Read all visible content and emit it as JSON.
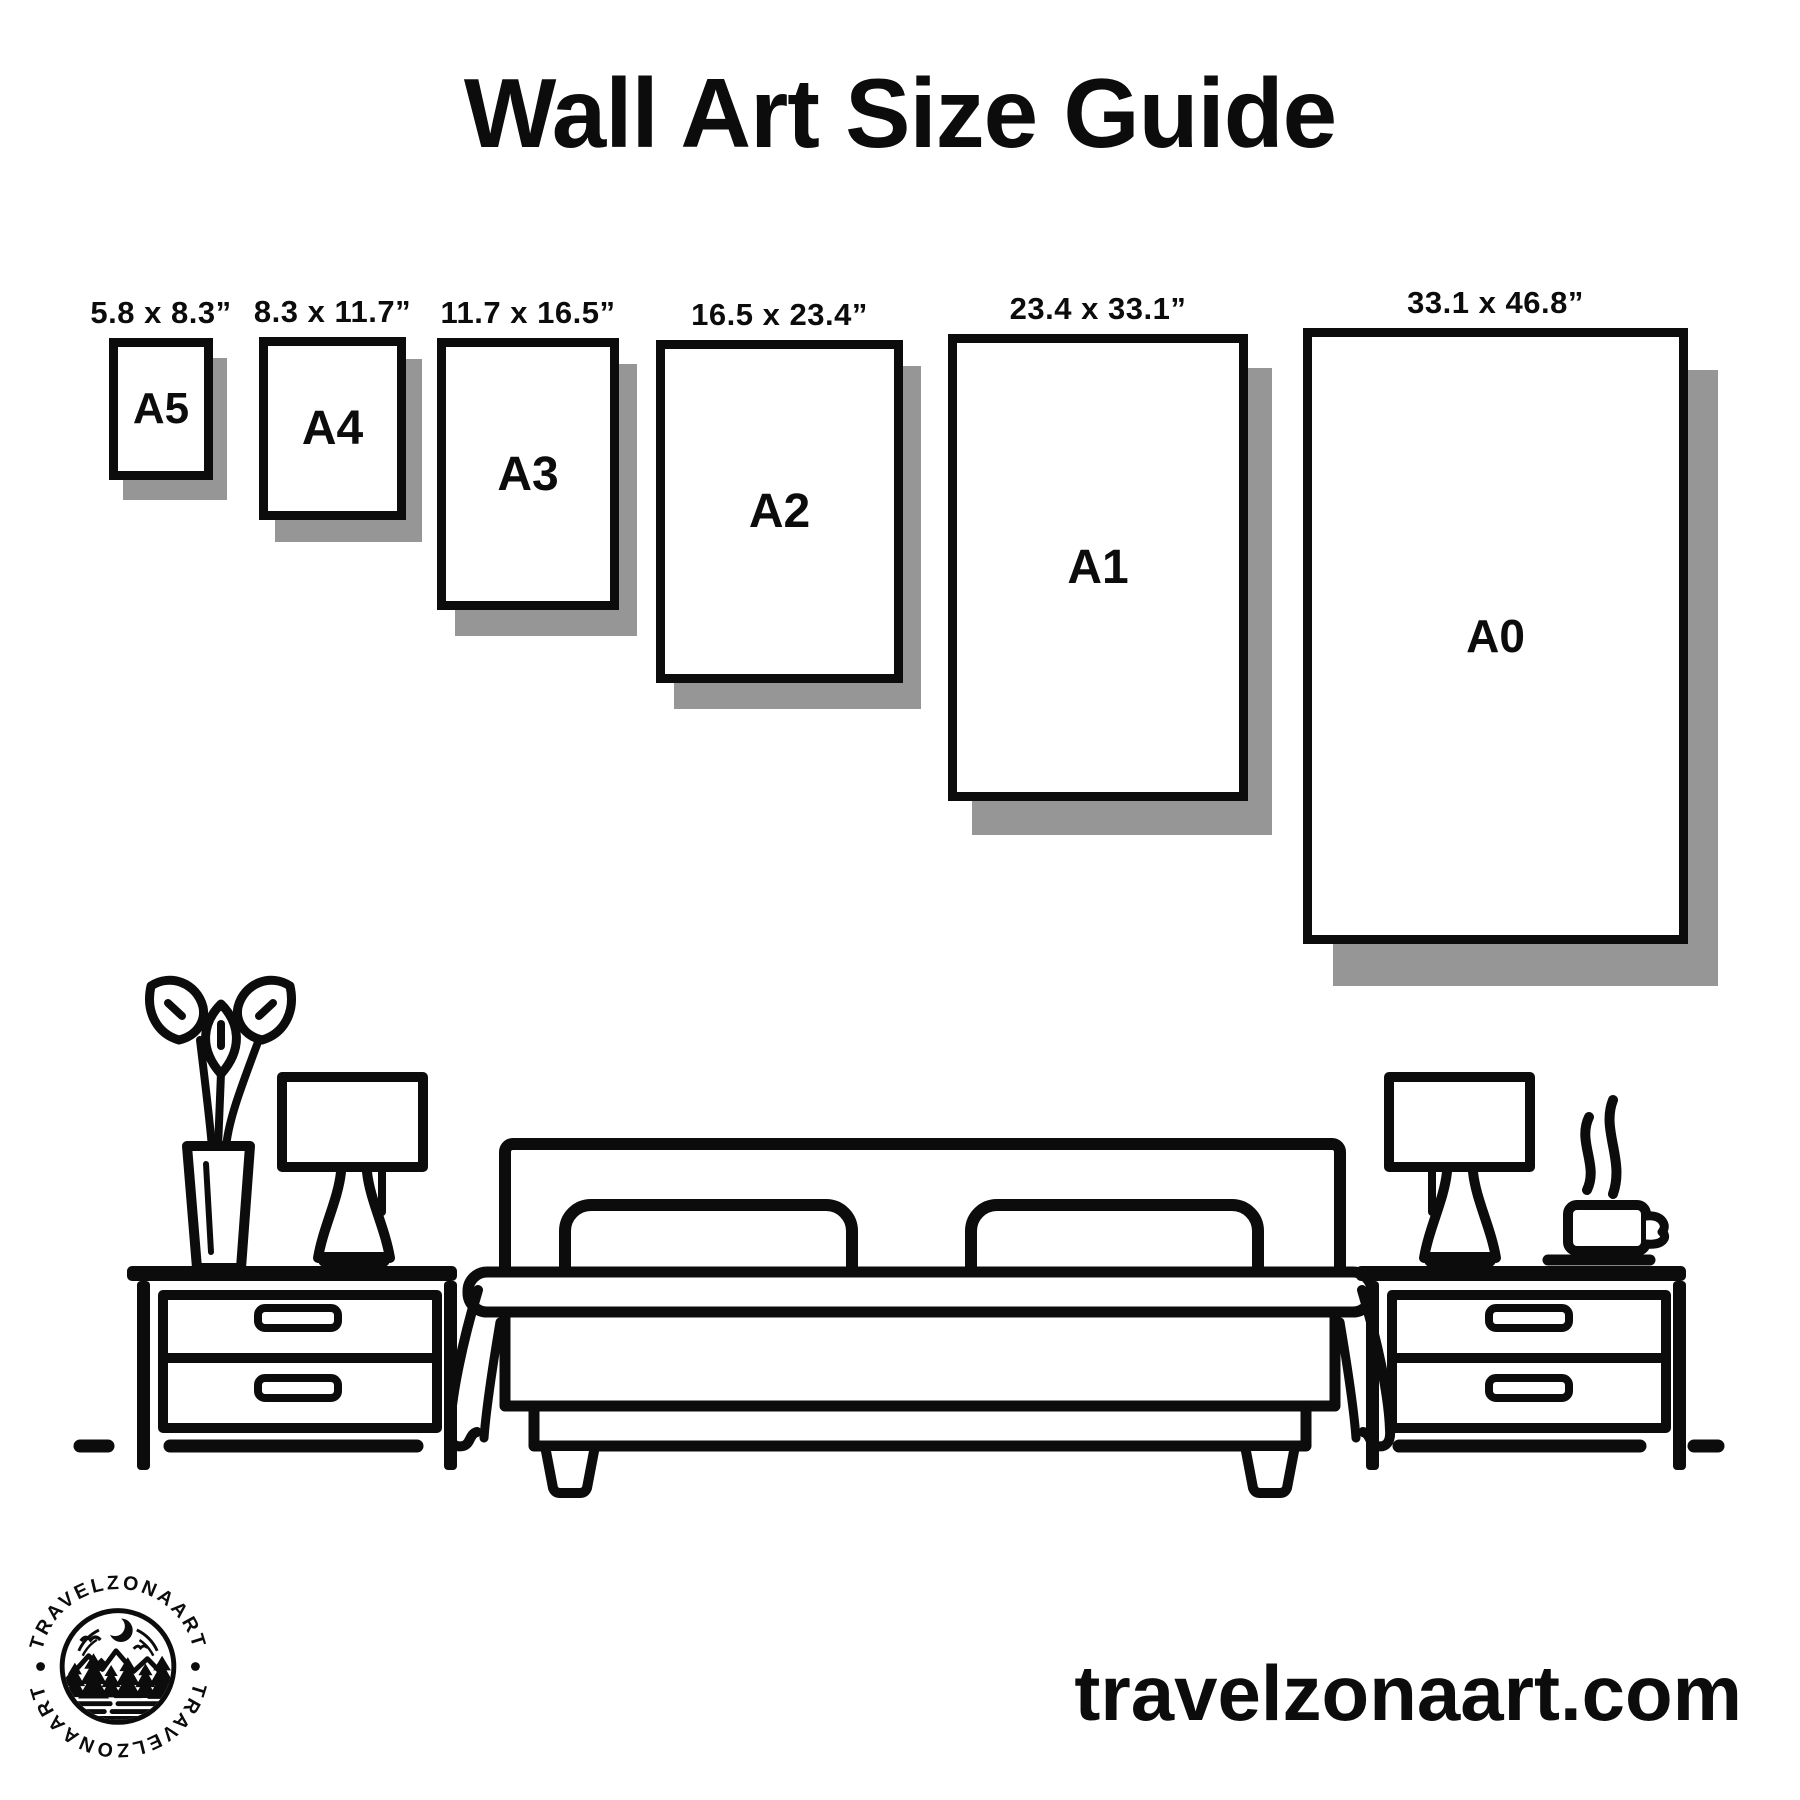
{
  "title": "Wall Art Size Guide",
  "frames": [
    {
      "code": "A5",
      "dims": "5.8 x 8.3”"
    },
    {
      "code": "A4",
      "dims": "8.3 x 11.7”"
    },
    {
      "code": "A3",
      "dims": "11.7 x 16.5”"
    },
    {
      "code": "A2",
      "dims": "16.5 x 23.4”"
    },
    {
      "code": "A1",
      "dims": "23.4 x 33.1”"
    },
    {
      "code": "A0",
      "dims": "33.1 x 46.8”"
    }
  ],
  "footer": {
    "website": "travelzonaart.com"
  },
  "logo": {
    "text_top": "TRAVELZONAART",
    "text_bottom": "TRAVELZONAART"
  },
  "colors": {
    "ink": "#0c0c0c",
    "shadow": "#969696",
    "background": "#ffffff"
  },
  "scene": {
    "icons": [
      "plant-vase-icon",
      "table-lamp-icon",
      "nightstand-icon",
      "bed-icon",
      "steam-icon",
      "coffee-cup-icon",
      "floor-line"
    ]
  }
}
